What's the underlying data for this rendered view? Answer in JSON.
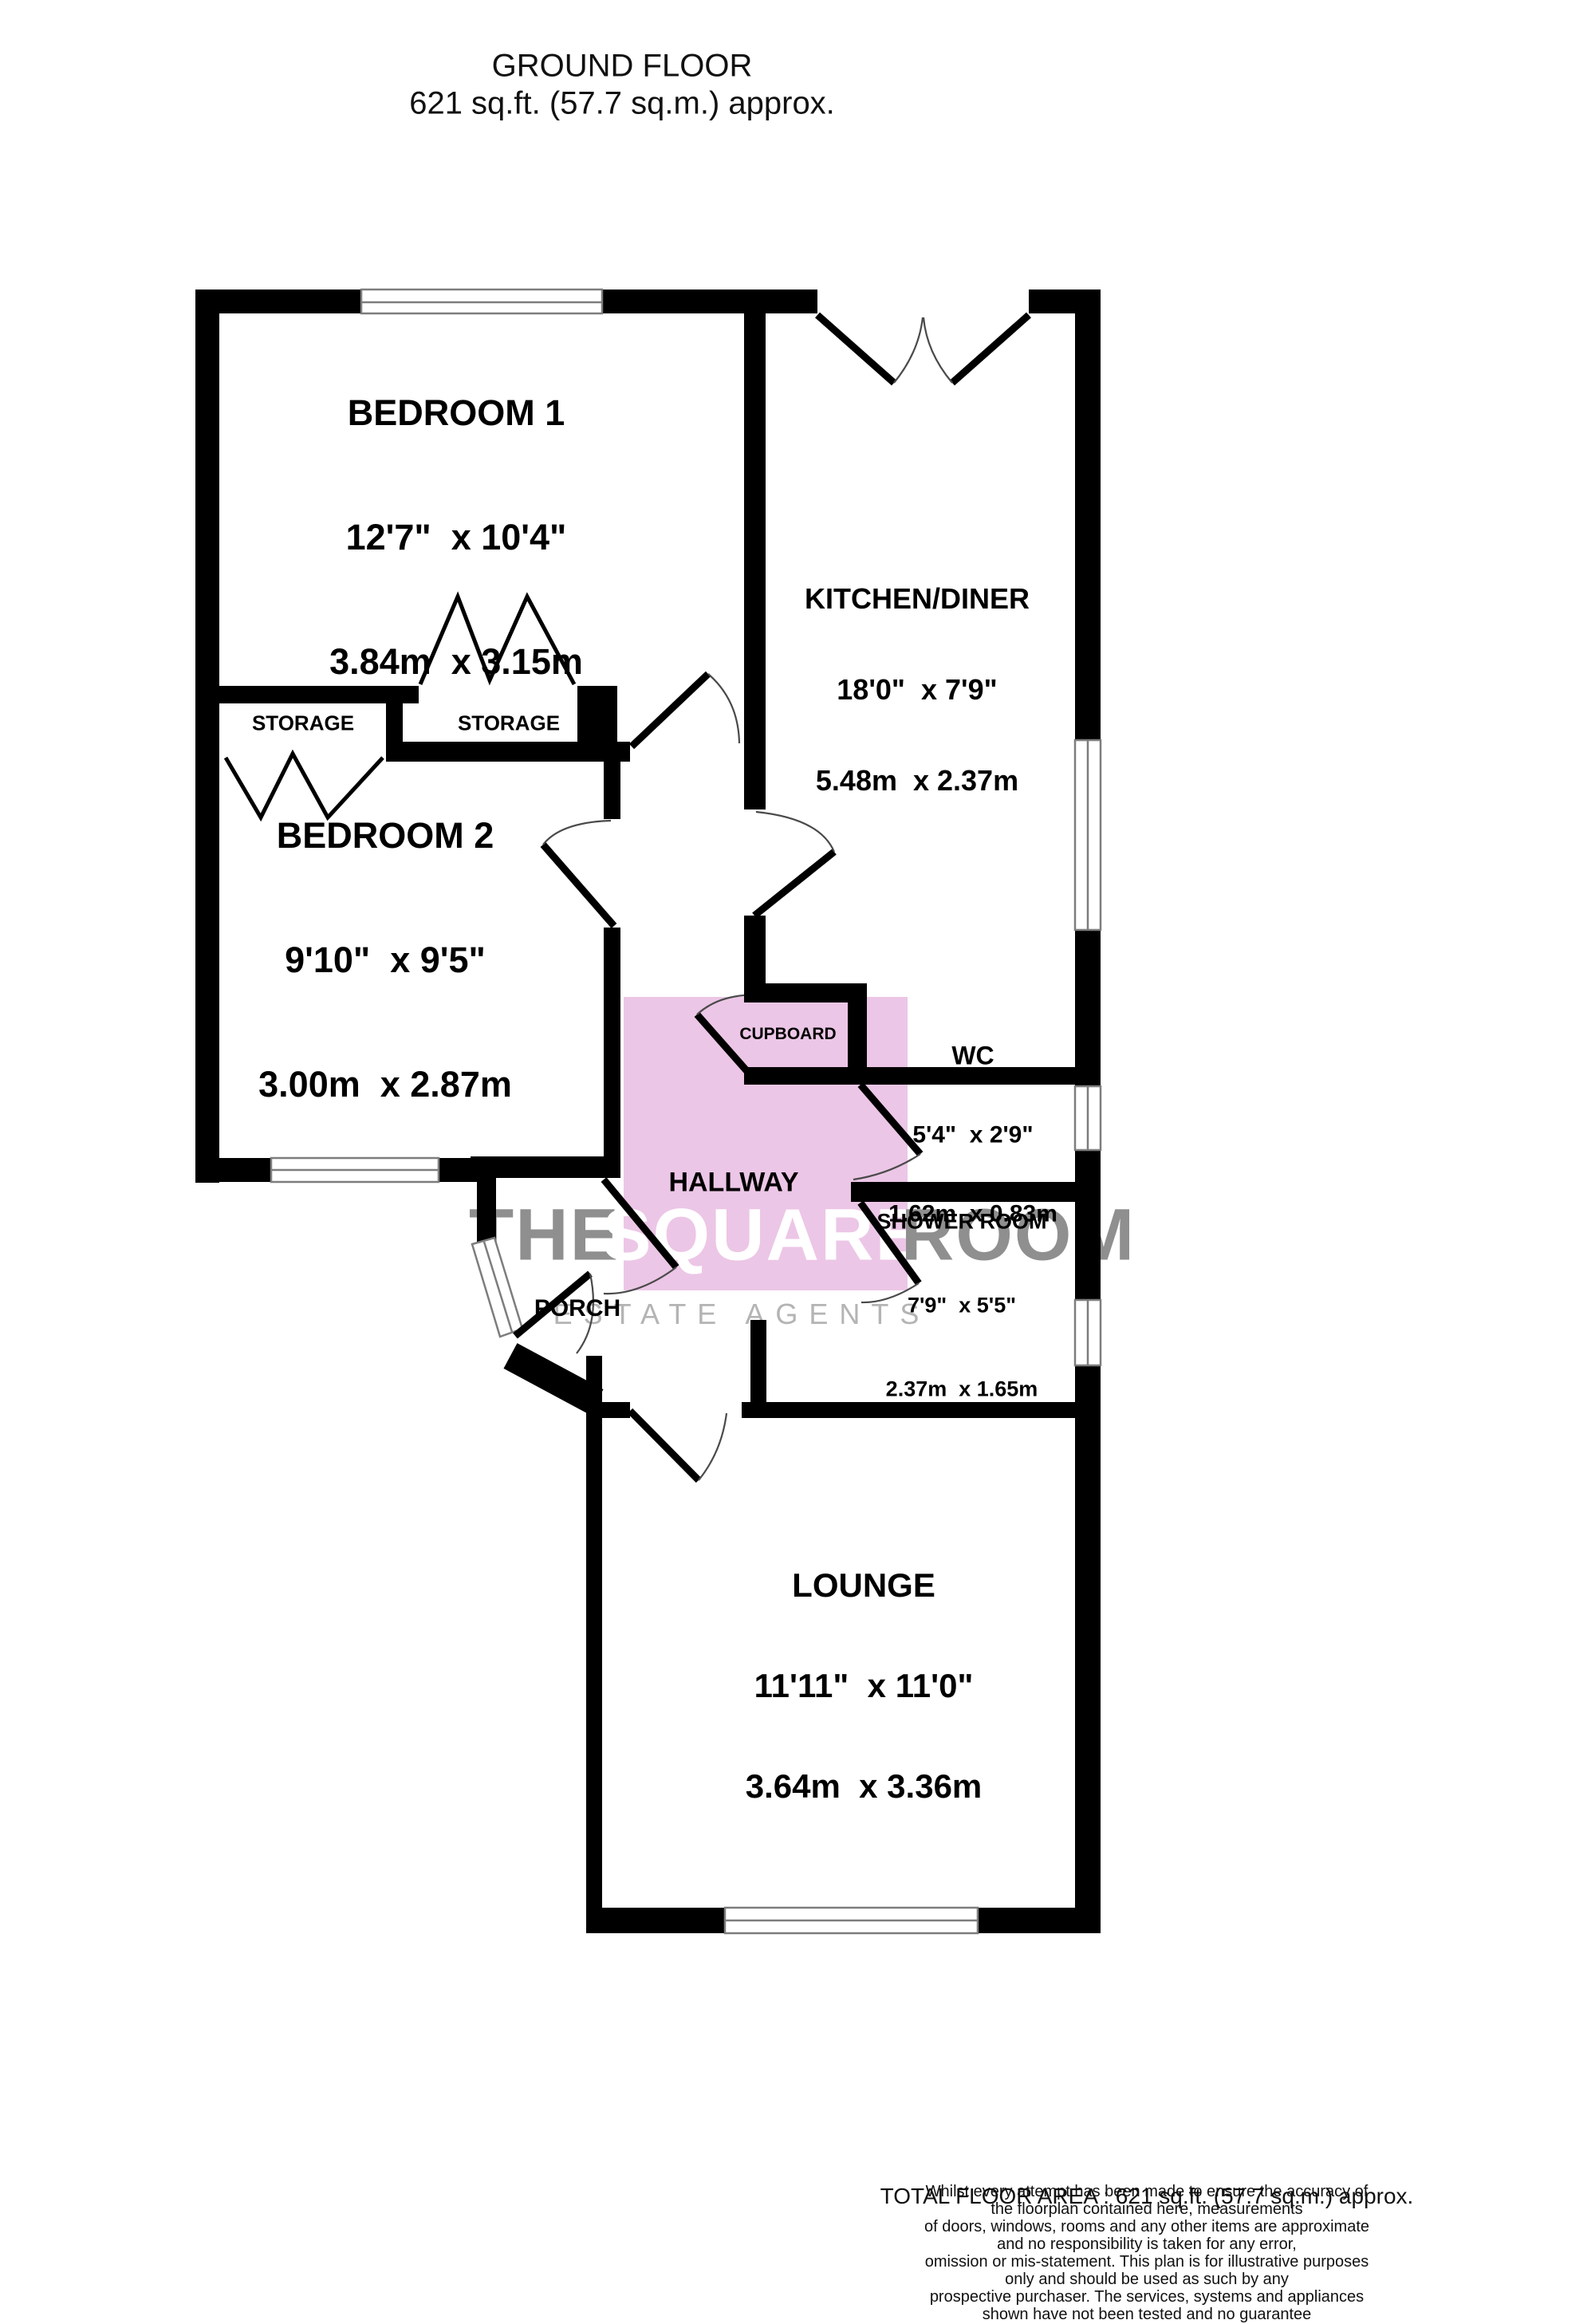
{
  "title": {
    "line1": "GROUND FLOOR",
    "line2": "621 sq.ft. (57.7 sq.m.) approx."
  },
  "watermark": {
    "word1": "THE",
    "word2": "SQUARE",
    "word3": "ROOM",
    "tagline": "ESTATE AGENTS"
  },
  "colors": {
    "hallway_pink": "#ecc6e6",
    "watermark_gray": "#8f8f8f",
    "tagline_gray": "#b4b4b4",
    "wall_black": "#000000",
    "window_gray": "#7d7d7d"
  },
  "rooms": {
    "bedroom1": {
      "name": "BEDROOM 1",
      "imperial": "12'7\"  x 10'4\"",
      "metric": "3.84m  x 3.15m"
    },
    "bedroom2": {
      "name": "BEDROOM 2",
      "imperial": "9'10\"  x 9'5\"",
      "metric": "3.00m  x 2.87m"
    },
    "kitchen": {
      "name": "KITCHEN/DINER",
      "imperial": "18'0\"  x 7'9\"",
      "metric": "5.48m  x 2.37m"
    },
    "lounge": {
      "name": "LOUNGE",
      "imperial": "11'11\"  x 11'0\"",
      "metric": "3.64m  x 3.36m"
    },
    "wc": {
      "name": "WC",
      "imperial": "5'4\"  x 2'9\"",
      "metric": "1.62m  x 0.83m"
    },
    "shower": {
      "name": "SHOWER ROOM",
      "imperial": "7'9\"  x 5'5\"",
      "metric": "2.37m  x 1.65m"
    },
    "hallway": {
      "name": "HALLWAY"
    },
    "porch": {
      "name": "PORCH"
    },
    "cupboard": {
      "name": "CUPBOARD"
    },
    "storage1": {
      "name": "STORAGE"
    },
    "storage2": {
      "name": "STORAGE"
    }
  },
  "footer": {
    "total": "TOTAL FLOOR AREA : 621 sq.ft. (57.7 sq.m.) approx.",
    "disclaimer1": "Whilst every attempt has been made to ensure the accuracy of the floorplan contained here, measurements",
    "disclaimer2": "of doors, windows, rooms and any other items are approximate and no responsibility is taken for any error,",
    "disclaimer3": "omission or mis-statement. This plan is for illustrative purposes only and should be used as such by any",
    "disclaimer4": "prospective purchaser. The services, systems and appliances shown have not been tested and no guarantee",
    "disclaimer5": "as to their operability or efficiency can be given.",
    "credit": "Made with Metropix ©2025"
  }
}
